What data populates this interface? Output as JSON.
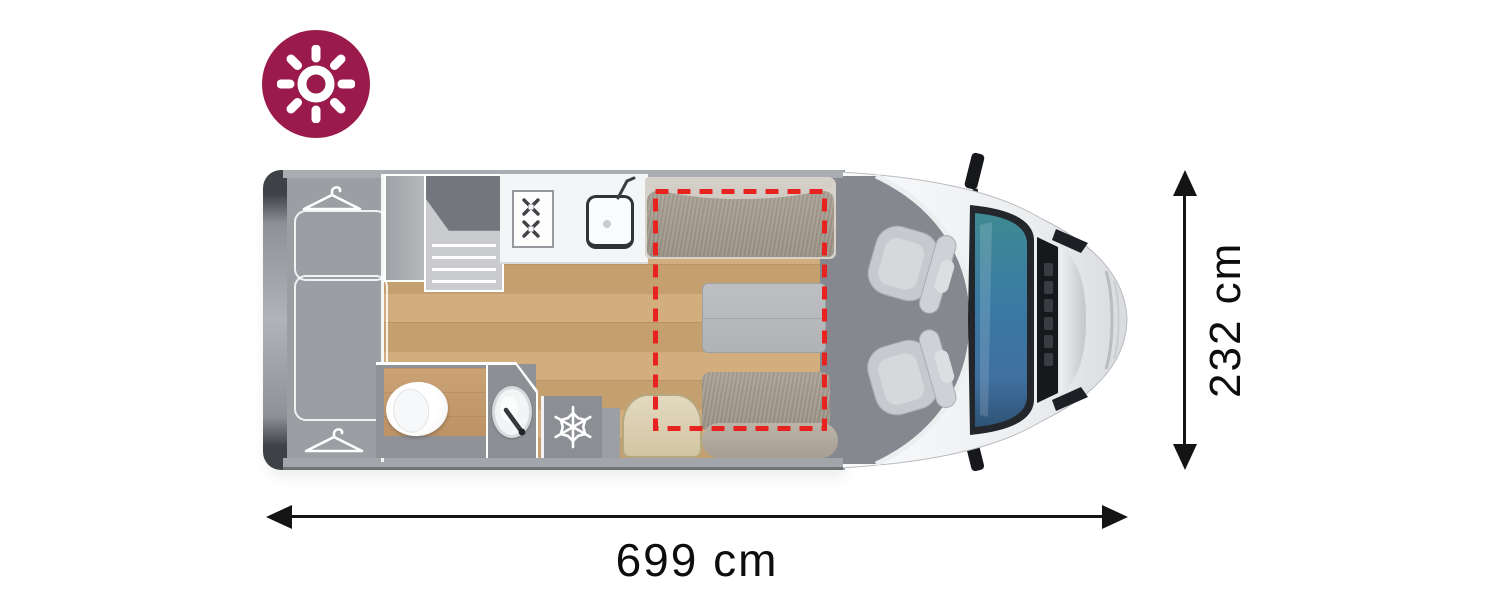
{
  "diagram": {
    "title": "Campervan floor plan (top view)",
    "badge": {
      "icon": "sun-icon",
      "background_color": "#9a1b4b",
      "icon_color": "#ffffff"
    },
    "dimensions": {
      "length": {
        "label": "699 cm"
      },
      "width": {
        "label": "232 cm"
      },
      "arrow_color": "#141414"
    },
    "floorplan": {
      "body_color": "#9b9ea3",
      "cab_floor_color": "#85888e",
      "wood_floor_color": "#cca876",
      "cushion_color": "#a59c90",
      "counter_color": "#f4f5f6",
      "table_color": "#b9bbbe",
      "stool_color": "#dcd0b2",
      "seat_color": "#c6c9ce",
      "windshield_color": "#3a74a6",
      "drop_down_bed_outline_color": "#e8231f",
      "features": [
        {
          "name": "rear-bed",
          "description": "Rear bed / wardrobe area",
          "icons": [
            "hanger-icon",
            "hanger-icon"
          ]
        },
        {
          "name": "steps",
          "description": "Step unit beside wardrobe"
        },
        {
          "name": "kitchen",
          "description": "Kitchenette with counter",
          "icons": [
            "two-burner-stove-icon",
            "kitchen-sink-icon",
            "faucet-icon"
          ]
        },
        {
          "name": "bathroom",
          "description": "Washroom",
          "icons": [
            "toilet-icon",
            "washbasin-icon",
            "faucet-icon"
          ]
        },
        {
          "name": "fridge",
          "description": "Refrigerator",
          "icons": [
            "snowflake-icon"
          ]
        },
        {
          "name": "dinette",
          "description": "Two bench seats, table and stool"
        },
        {
          "name": "drop-down-bed",
          "description": "Drop-down bed area marked with red dashed outline"
        },
        {
          "name": "cab",
          "description": "Driver cab with two swivel seats, windscreen and mirrors",
          "icons": [
            "seat-icon",
            "seat-icon",
            "mirror-icon",
            "mirror-icon"
          ]
        }
      ]
    }
  }
}
